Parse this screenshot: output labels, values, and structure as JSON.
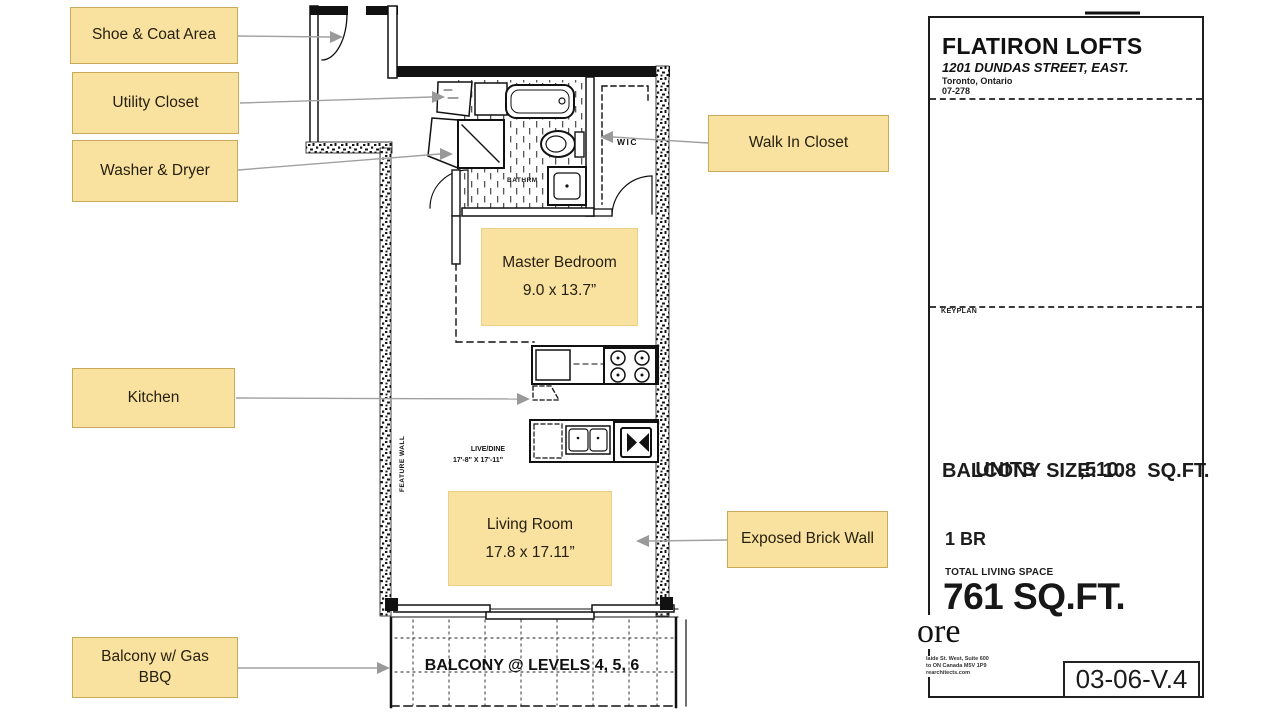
{
  "colors": {
    "callout_fill": "#F9E2A0",
    "callout_border": "#C9AA5C",
    "leader_line": "#A0A0A0",
    "wall_ink": "#111111"
  },
  "callouts": {
    "shoe_coat": "Shoe & Coat Area",
    "utility": "Utility Closet",
    "washer_dryer": "Washer & Dryer",
    "kitchen": "Kitchen",
    "balcony_bbq": "Balcony w/ Gas BBQ",
    "walk_in": "Walk In Closet",
    "exposed_brick": "Exposed Brick Wall"
  },
  "rooms": {
    "master": {
      "name": "Master Bedroom",
      "dims": "9.0 x 13.7”"
    },
    "living": {
      "name": "Living Room",
      "dims": "17.8 x 17.11”"
    }
  },
  "plan": {
    "wic": "WIC",
    "bathroom": "BATHRM",
    "live_dine": "LIVE/DINE",
    "live_dine_dims": "17'-8\" X 17'-11\"",
    "feature_wall": "FEATURE WALL",
    "balcony": "BALCONY @ LEVELS 4, 5, 6"
  },
  "panel": {
    "title": "FLATIRON LOFTS",
    "address": "1201 DUNDAS STREET, EAST.",
    "city": "Toronto, Ontario",
    "project_no": "07-278",
    "keyplan_label": "KEYPLAN",
    "compass_n": "N",
    "units_label": "UNITS",
    "units_value": ",510.",
    "balcony_size": "BALCONY SIZE: 108  SQ.FT.",
    "bedroom_type": "1 BR",
    "total_living_label": "TOTAL LIVING SPACE",
    "total_living_value": "761 SQ.FT.",
    "logo_fragment": "ore",
    "address_line1": "laide St. West, Suite 600",
    "address_line2": "to ON Canada M5V 1P9",
    "address_line3": "rearchitects.com",
    "drawing_no": "03-06-V.4"
  }
}
